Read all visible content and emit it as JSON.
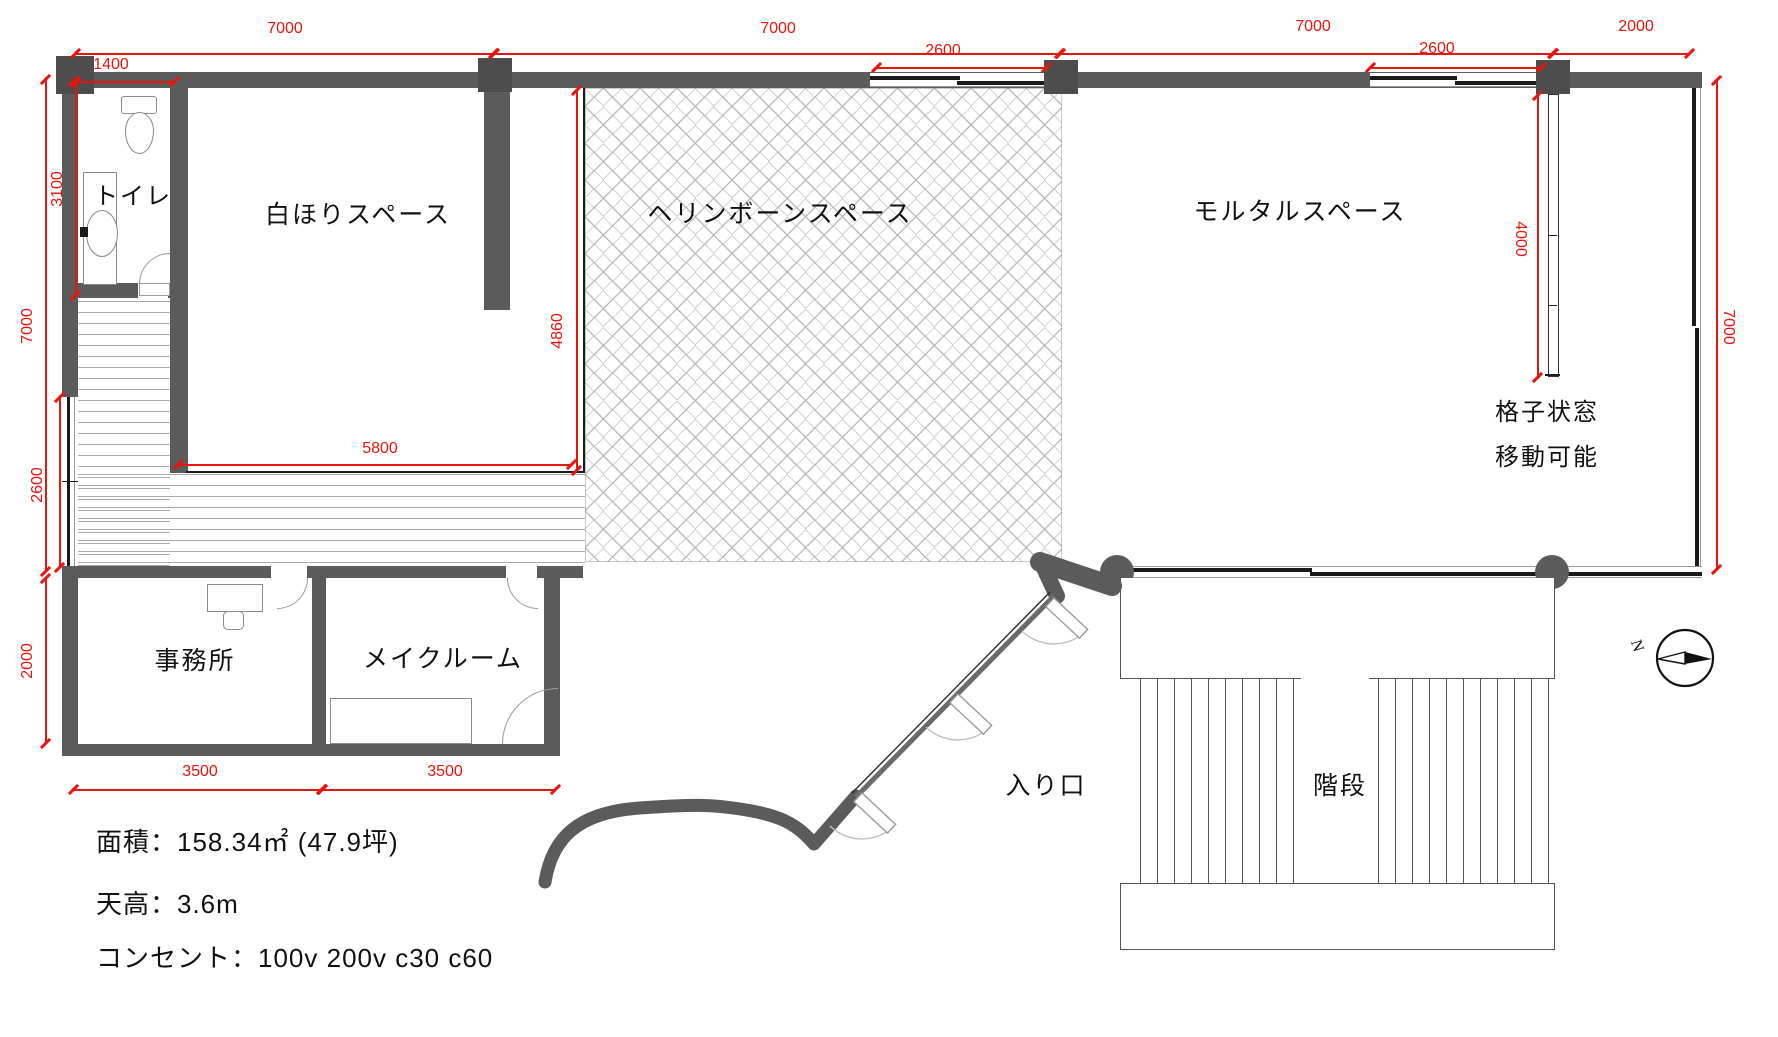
{
  "rooms": {
    "toilet": "トイレ",
    "white_hori": "白ほりスペース",
    "herringbone": "ヘリンボーンスペース",
    "mortar": "モルタルスペース",
    "office": "事務所",
    "make_room": "メイクルーム",
    "entrance": "入り口",
    "stairs": "階段"
  },
  "annotations": {
    "lattice_line1": "格子状窓",
    "lattice_line2": "移動可能"
  },
  "dimensions": {
    "top_span_left": "7000",
    "toilet_width": "1400",
    "top_span_mid": "7000",
    "herringbone_window": "2600",
    "top_span_right": "7000",
    "mortar_window": "2600",
    "top_span_end": "2000",
    "left_toilet_height": "3100",
    "left_total_height": "7000",
    "left_window": "2600",
    "left_office_height": "2000",
    "white_hori_height": "4860",
    "white_hori_width": "5800",
    "lattice_length": "4000",
    "right_height": "7000",
    "office_width": "3500",
    "make_room_width": "3500"
  },
  "info": {
    "area": "面積：158.34㎡ (47.9坪)",
    "ceiling": "天高：3.6m",
    "outlets": "コンセント：100v 200v c30  c60"
  },
  "compass": {
    "north_label": "N"
  },
  "colors": {
    "wall": "#5b5b5b",
    "dimension": "#e8140e",
    "line": "#1a1a1a"
  }
}
